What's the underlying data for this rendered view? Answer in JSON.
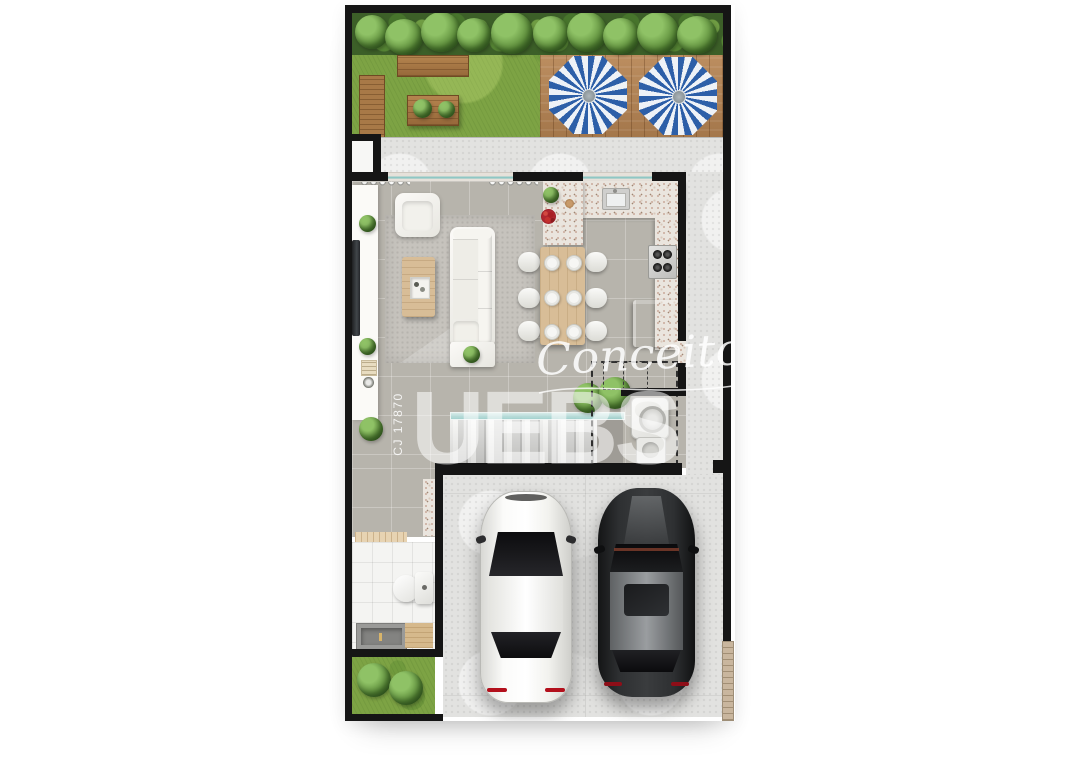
{
  "watermarks": {
    "script": "Conceito",
    "brand": "UEBS",
    "license": "CJ 17870"
  },
  "palette": {
    "background": "#ffffff",
    "wall_black": "#151515",
    "grass_green": "#7da344",
    "hedge_green": "#3c5f28",
    "deck_wood": "#b4875a",
    "umbrella_blue": "#2d5fa8",
    "umbrella_white": "#eef2f7",
    "interior_floor_gray": "#b7b4ac",
    "concrete_gray": "#e2e2e0",
    "granite_counter": "#eae5de",
    "furniture_wood": "#d8bd97",
    "white_car": "#f4f4f2",
    "dark_car": "#2b2d2e",
    "glass_teal": "#8fc7c4",
    "watermark_white": "rgba(255,255,255,0.55)"
  },
  "scene": {
    "type": "residential-floor-plan-top-view",
    "rooms": [
      "garden",
      "wood-deck",
      "walkway",
      "living-room",
      "dining-area",
      "kitchen",
      "stairs",
      "laundry",
      "hallway",
      "bathroom",
      "side-yard",
      "garage-driveway"
    ],
    "objects": [
      "hedge",
      "garden-bench",
      "planter-bench",
      "garden-table",
      "parasol-blue-white",
      "parasol-blue-white",
      "tv-console",
      "tv",
      "armchair",
      "sofa",
      "coffee-table",
      "side-table",
      "rug",
      "dining-table",
      "dining-chairs-x6",
      "kitchen-sink",
      "cooktop",
      "refrigerator",
      "washing-machine",
      "laundry-tank",
      "toilet",
      "bathroom-sink-counter",
      "white-car",
      "dark-car",
      "gate"
    ]
  }
}
